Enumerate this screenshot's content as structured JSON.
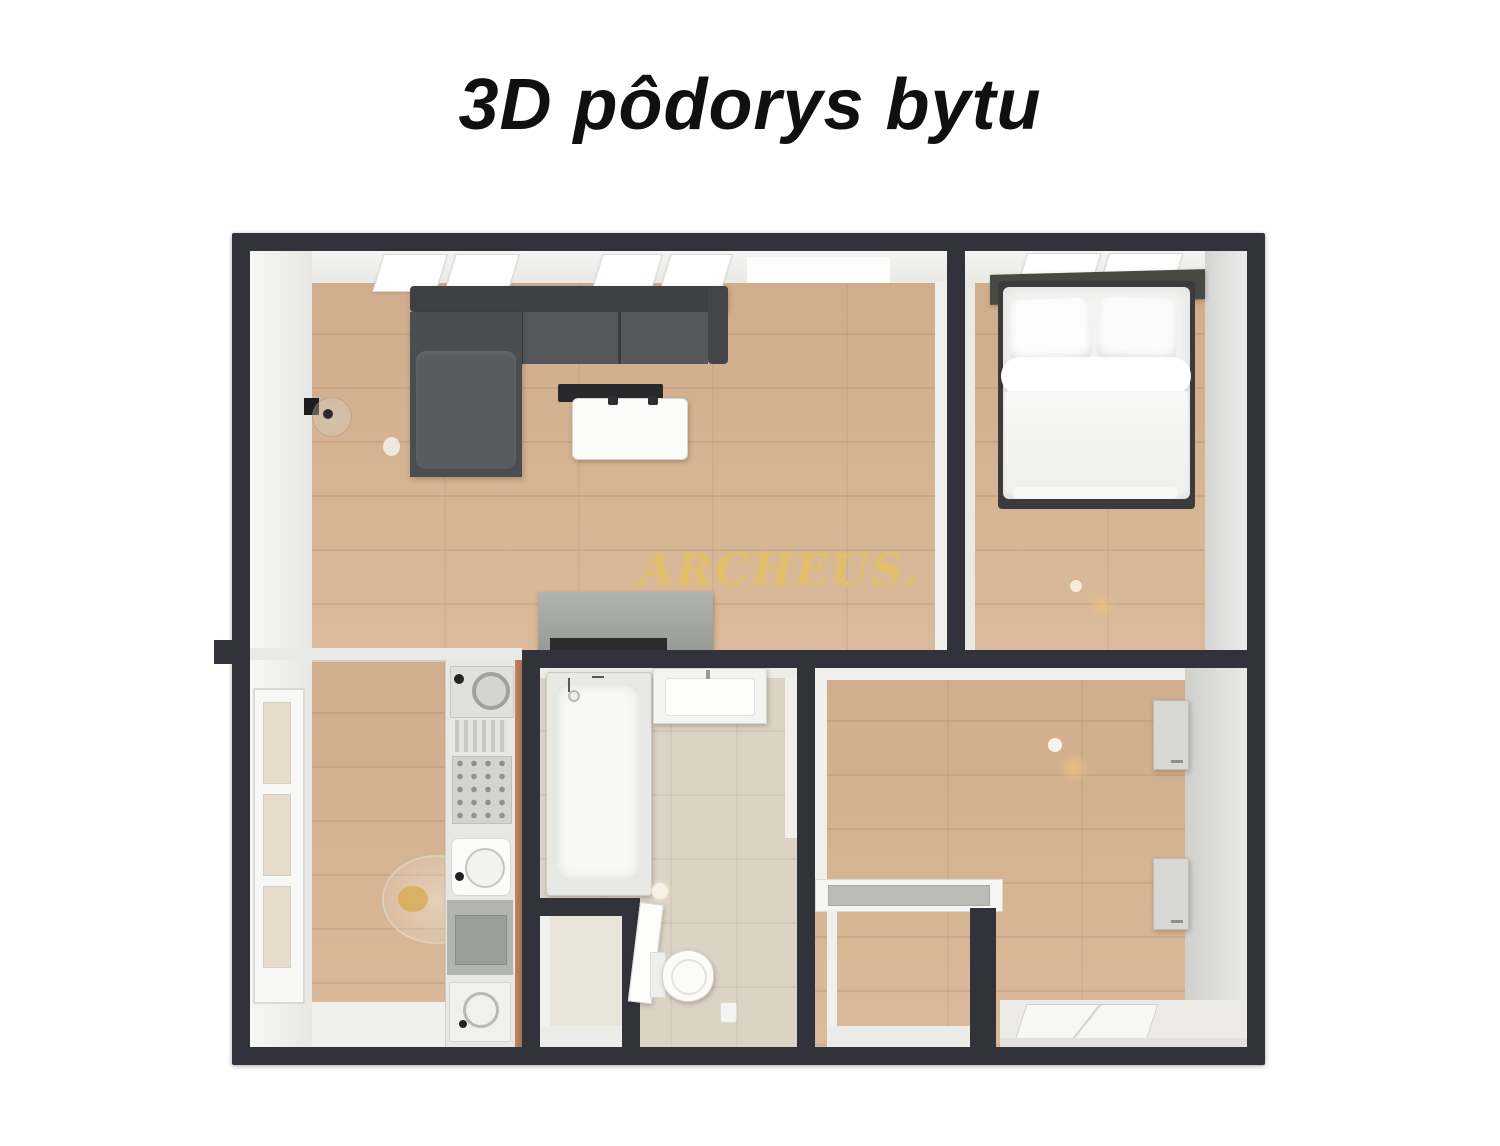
{
  "title": "3D pôdorys bytu",
  "watermark": "ARCHEUS.",
  "palette": {
    "wall": "#32323a",
    "wood_floor": "#d6b493",
    "tile_floor": "#dbd4c5",
    "accent_gold": "#e2bf66",
    "sofa_dark": "#43454a",
    "sofa_light": "#54575c",
    "title_color": "#101010"
  }
}
